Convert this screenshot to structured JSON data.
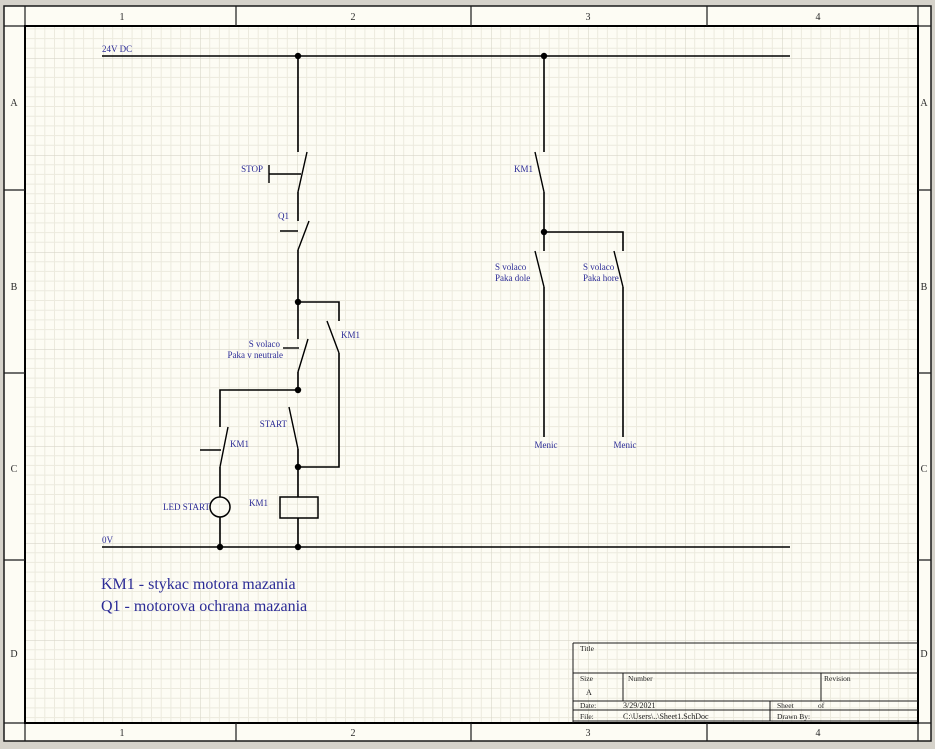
{
  "sheet": {
    "columns": [
      "1",
      "2",
      "3",
      "4"
    ],
    "rows": [
      "A",
      "B",
      "C",
      "D"
    ],
    "colors": {
      "canvas_bg": "#d5d2ca",
      "sheet_bg": "#fdfcf4",
      "grid_minor": "#eceade",
      "grid_major": "#d8d6c9",
      "border": "#000000",
      "wire": "#000000",
      "label_blue": "#2b2b96"
    }
  },
  "circuit": {
    "rail_top_label": "24V DC",
    "rail_bottom_label": "0V",
    "stop_label": "STOP",
    "q1_label": "Q1",
    "km1_latch_label": "KM1",
    "svolaco_neutral_line1": "S volaco",
    "svolaco_neutral_line2": "Paka v neutrale",
    "km1_aux_label": "KM1",
    "start_label": "START",
    "led_start_label": "LED START",
    "km1_coil_label": "KM1",
    "km1_right_label": "KM1",
    "svolaco_dole_line1": "S volaco",
    "svolaco_dole_line2": "Paka dole",
    "svolaco_hore_line1": "S volaco",
    "svolaco_hore_line2": "Paka hore",
    "menic_left_label": "Menic",
    "menic_right_label": "Menic"
  },
  "annotations": {
    "line1": "KM1 - stykac motora mazania",
    "line2": "Q1 - motorova ochrana mazania"
  },
  "title_block": {
    "title_label": "Title",
    "size_label": "Size",
    "size_value": "A",
    "number_label": "Number",
    "revision_label": "Revision",
    "date_label": "Date:",
    "date_value": "3/29/2021",
    "sheet_label": "Sheet",
    "of_label": "of",
    "file_label": "File:",
    "file_value": "C:\\Users\\..\\Sheet1.SchDoc",
    "drawnby_label": "Drawn By:"
  }
}
